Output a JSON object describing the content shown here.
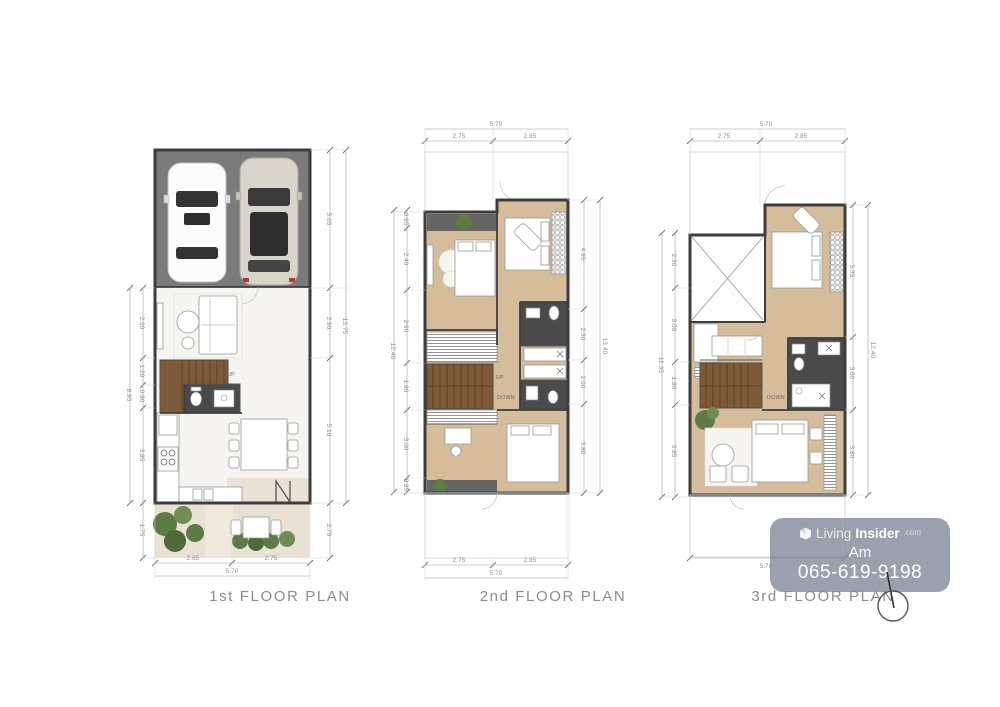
{
  "plans": [
    {
      "label": "1st FLOOR PLAN",
      "stair": {
        "up": "UP"
      },
      "dims": {
        "left1": "2.90",
        "left2": "1.20",
        "left3": "0.90",
        "left4": "3.85",
        "left5": "1.75",
        "left_total": "8.95",
        "right1": "5.65",
        "right2": "2.90",
        "right3": "5.10",
        "right4": "2.70",
        "right_total": "13.75",
        "bottom1": "2.85",
        "bottom2": "2.75",
        "bottom_total": "5.70"
      }
    },
    {
      "label": "2nd FLOOR PLAN",
      "stair": {
        "up": "UP",
        "down": "DOWN"
      },
      "dims": {
        "top1": "2.75",
        "top2": "2.85",
        "top_total": "5.70",
        "left1": "0.95",
        "left2": "2.40",
        "left3": "2.90",
        "left4": "1.80",
        "left5": "3.00",
        "left6": "0.85",
        "left_total": "12.40",
        "right1": "4.95",
        "right2": "2.30",
        "right3": "2.00",
        "right4": "3.80",
        "right_total": "13.40",
        "bottom1": "2.75",
        "bottom2": "2.85",
        "bottom_total": "5.70"
      }
    },
    {
      "label": "3rd FLOOR PLAN",
      "stair": {
        "down": "DOWN"
      },
      "dims": {
        "top1": "2.75",
        "top2": "2.85",
        "top_total": "5.70",
        "left1": "2.30",
        "left2": "3.00",
        "left3": "1.80",
        "left4": "3.95",
        "left_total": "11.35",
        "right1": "5.35",
        "right2": "3.00",
        "right3": "3.80",
        "right_total": "12.40",
        "bottom_total": "5.70"
      }
    }
  ],
  "watermark": {
    "brand_prefix": "Living",
    "brand_suffix": "Insider",
    "brand_tld": ".com",
    "agent_name": "Am",
    "phone": "065-619-9198"
  },
  "colors": {
    "wall": "#3d3d3d",
    "garage_floor": "#7b7b7b",
    "marble_floor": "#f5f4f1",
    "wood_floor": "#d5bd9c",
    "stair_wood": "#7d5a38",
    "dark_tile": "#4a4a4a",
    "terrace": "#e9e2d4",
    "plant": "#5e7b46",
    "dim_text": "#8a8a8a",
    "watermark_bg": "#7d8596",
    "label_text": "#8d8d8d"
  }
}
